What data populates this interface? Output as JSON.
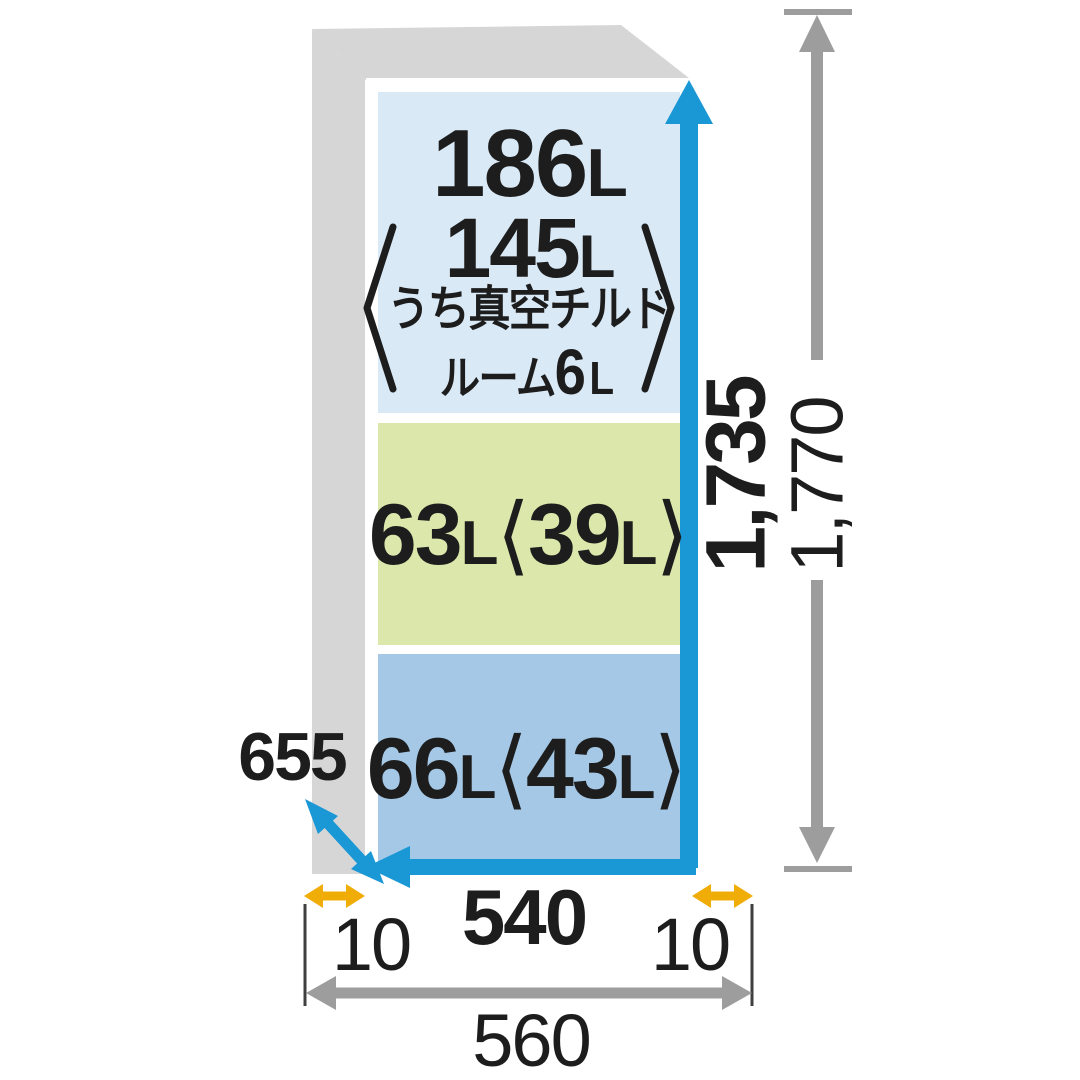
{
  "title": "refrigerator-capacity-and-dimensions-diagram",
  "compartments": {
    "main": {
      "total": {
        "num": "186",
        "unit": "L"
      },
      "fridge": {
        "num": "145",
        "unit": "L"
      },
      "note1": "うち真空チルド",
      "note2": {
        "pre": "ルーム",
        "num": "6",
        "unit": "L"
      }
    },
    "vegetable": {
      "num": "63",
      "unit": "L",
      "open": "⟨",
      "sub_num": "39",
      "sub_unit": "L",
      "close": "⟩"
    },
    "freezer": {
      "num": "66",
      "unit": "L",
      "open": "⟨",
      "sub_num": "43",
      "sub_unit": "L",
      "close": "⟩"
    }
  },
  "dimensions": {
    "depth": "655",
    "body_width": "540",
    "left_clearance": "10",
    "right_clearance": "10",
    "total_width": "560",
    "body_height": "1,735",
    "total_height": "1,770"
  },
  "colors": {
    "body_gray": "#d6d6d6",
    "cabinet_blue": "#d9e9f6",
    "vegetable_green": "#dbe7ab",
    "freezer_blue": "#a4c8e6",
    "accent_blue": "#1a97d5",
    "accent_yellow": "#f0ad08",
    "dim_gray": "#9d9d9d",
    "ext_line": "#3f3f3f",
    "text": "#1d1d1d"
  }
}
